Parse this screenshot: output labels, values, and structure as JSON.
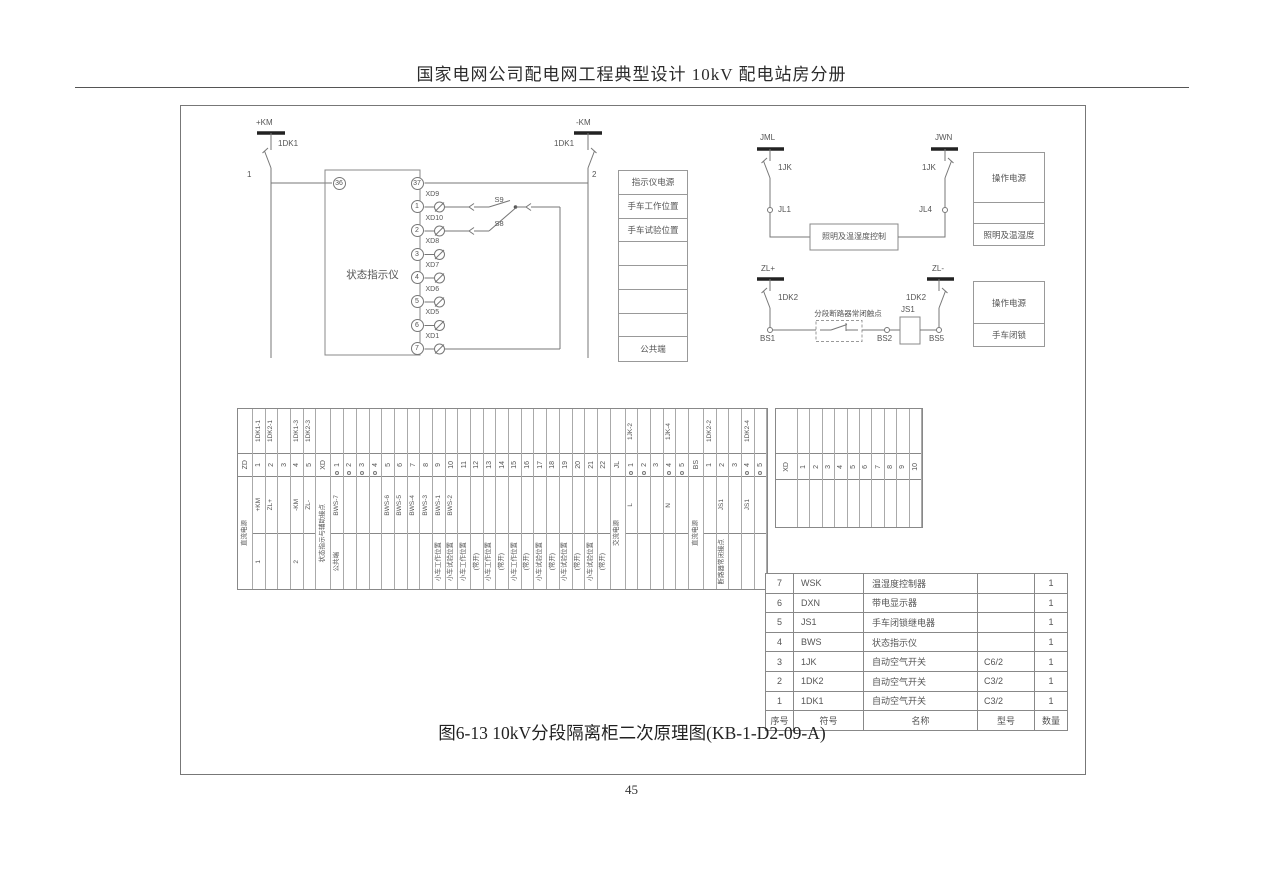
{
  "page": {
    "header_title": "国家电网公司配电网工程典型设计  10kV 配电站房分册",
    "caption": "图6-13 10kV分段隔离柜二次原理图(KB-1-D2-09-A)",
    "page_number": "45"
  },
  "indicator_circuit": {
    "bus_left": "+KM",
    "bus_right": "-KM",
    "breaker_left": "1DK1",
    "breaker_right": "1DK1",
    "node_left": "1",
    "node_right": "2",
    "device_label": "状态指示仪",
    "terminal_in": "36",
    "terminal_out": "37",
    "rows": [
      {
        "term": "1",
        "lamp": "XD9",
        "switch": "S9"
      },
      {
        "term": "2",
        "lamp": "XD10",
        "switch": "S8"
      },
      {
        "term": "3",
        "lamp": "XD8"
      },
      {
        "term": "4",
        "lamp": "XD7"
      },
      {
        "term": "5",
        "lamp": "XD6"
      },
      {
        "term": "6",
        "lamp": "XD5"
      },
      {
        "term": "7",
        "lamp": "XD1"
      }
    ],
    "legend_rows": [
      "指示仪电源",
      "手车工作位置",
      "手车试验位置",
      "",
      "",
      "",
      "",
      "公共端"
    ]
  },
  "lighting_circuit": {
    "bus_left": "JML",
    "bus_right": "JWN",
    "breaker_left": "1JK",
    "breaker_right": "1JK",
    "terminal_left": "JL1",
    "terminal_right": "JL4",
    "controller_label": "照明及温湿度控制",
    "legend_rows": [
      "操作电源",
      "",
      "照明及温湿度"
    ]
  },
  "interlock_circuit": {
    "bus_left": "ZL+",
    "bus_right": "ZL-",
    "breaker_left": "1DK2",
    "breaker_right": "1DK2",
    "terminal_left": "BS1",
    "terminal_mid": "BS2",
    "terminal_right": "BS5",
    "contact_label": "分段断路器常闭触点",
    "relay_label": "JS1",
    "legend_rows": [
      "操作电源",
      "手车闭锁"
    ]
  },
  "terminal_strip": {
    "groups": [
      {
        "name": "ZD",
        "function": "直流电源",
        "cols": [
          {
            "top": "1DK1-1",
            "num": "1",
            "mid": "+KM",
            "bottom": "1"
          },
          {
            "top": "1DK2-1",
            "num": "2",
            "mid": "ZL+"
          },
          {
            "num": "3"
          },
          {
            "top": "1DK1-3",
            "num": "4",
            "mid": "-KM",
            "bottom": "2"
          },
          {
            "top": "1DK2-3",
            "num": "5",
            "mid": "ZL-"
          }
        ]
      },
      {
        "name": "XD",
        "function": "状态指示与辅助接点",
        "cols": [
          {
            "num": "1",
            "jump": true,
            "mid": "BWS-7",
            "bottom": "公共端"
          },
          {
            "num": "2",
            "jump": true
          },
          {
            "num": "3",
            "jump": true
          },
          {
            "num": "4",
            "jump": true
          },
          {
            "num": "5",
            "mid": "BWS-6"
          },
          {
            "num": "6",
            "mid": "BWS-5"
          },
          {
            "num": "7",
            "mid": "BWS-4"
          },
          {
            "num": "8",
            "mid": "BWS-3"
          },
          {
            "num": "9",
            "mid": "BWS-1",
            "bottom": "小车工作位置"
          },
          {
            "num": "10",
            "mid": "BWS-2",
            "bottom": "小车试验位置"
          },
          {
            "num": "11",
            "bottom": "小车工作位置"
          },
          {
            "num": "12",
            "bottom": "(常开)"
          },
          {
            "num": "13",
            "bottom": "小车工作位置"
          },
          {
            "num": "14",
            "bottom": "(常开)"
          },
          {
            "num": "15",
            "bottom": "小车工作位置"
          },
          {
            "num": "16",
            "bottom": "(常开)"
          },
          {
            "num": "17",
            "bottom": "小车试验位置"
          },
          {
            "num": "18",
            "bottom": "(常开)"
          },
          {
            "num": "19",
            "bottom": "小车试验位置"
          },
          {
            "num": "20",
            "bottom": "(常开)"
          },
          {
            "num": "21",
            "bottom": "小车试验位置"
          },
          {
            "num": "22",
            "bottom": "(常开)"
          }
        ]
      },
      {
        "name": "JL",
        "function": "交流电源",
        "cols": [
          {
            "top": "1JK-2",
            "num": "1",
            "jump": true,
            "mid": "L"
          },
          {
            "num": "2",
            "jump": true
          },
          {
            "num": "3"
          },
          {
            "top": "1JK-4",
            "num": "4",
            "jump": true,
            "mid": "N"
          },
          {
            "num": "5",
            "jump": true
          }
        ]
      },
      {
        "name": "BS",
        "function": "直流电源",
        "cols": [
          {
            "top": "1DK2-2",
            "num": "1"
          },
          {
            "num": "2",
            "mid": "JS1",
            "bottom": "断路器常闭接点"
          },
          {
            "num": "3"
          },
          {
            "top": "1DK2-4",
            "num": "4",
            "jump": true,
            "mid": "JS1"
          },
          {
            "num": "5",
            "jump": true
          }
        ]
      }
    ]
  },
  "xd_strip": {
    "name": "XD",
    "cols": [
      "1",
      "2",
      "3",
      "4",
      "5",
      "6",
      "7",
      "8",
      "9",
      "10"
    ]
  },
  "parts_table": {
    "headers": [
      "序号",
      "符号",
      "名称",
      "型号",
      "数量"
    ],
    "rows": [
      [
        "7",
        "WSK",
        "温湿度控制器",
        "",
        "1"
      ],
      [
        "6",
        "DXN",
        "带电显示器",
        "",
        "1"
      ],
      [
        "5",
        "JS1",
        "手车闭锁继电器",
        "",
        "1"
      ],
      [
        "4",
        "BWS",
        "状态指示仪",
        "",
        "1"
      ],
      [
        "3",
        "1JK",
        "自动空气开关",
        "C6/2",
        "1"
      ],
      [
        "2",
        "1DK2",
        "自动空气开关",
        "C3/2",
        "1"
      ],
      [
        "1",
        "1DK1",
        "自动空气开关",
        "C3/2",
        "1"
      ]
    ]
  }
}
